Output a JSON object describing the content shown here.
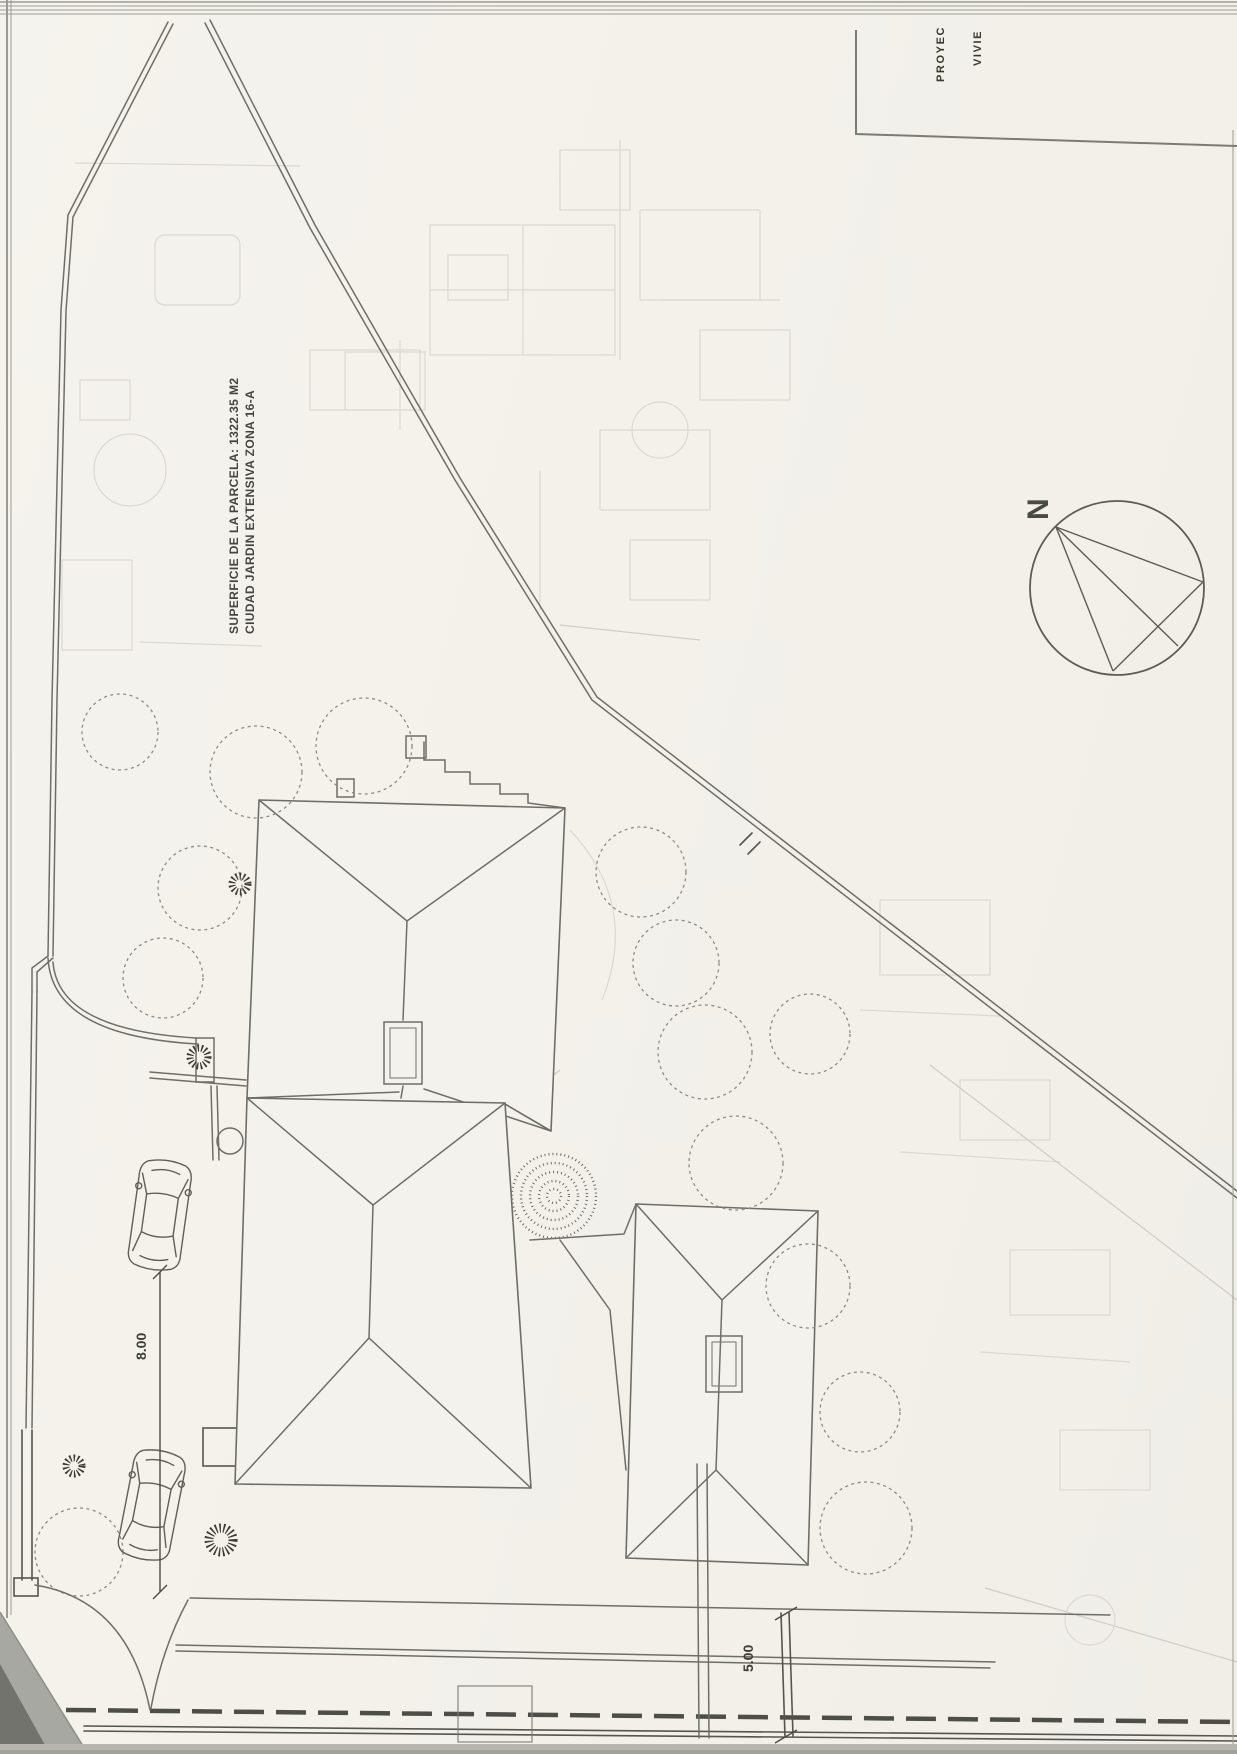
{
  "document": {
    "kind": "scanned architectural site plan (rotated landscape drawing)",
    "title_block": {
      "line1": "PROYEC",
      "line2": "VIVIE"
    },
    "annotations": {
      "parcel": {
        "line1": "SUPERFICIE DE LA PARCELA: 1322.35 M2",
        "line2": "CIUDAD JARDIN EXTENSIVA ZONA 16-A"
      },
      "north_label": "N",
      "dimension_8": "8.00",
      "dimension_5": "5.00"
    },
    "colors": {
      "paper": "#f3f1eb",
      "ink": "#6e6e68",
      "ink_dark": "#55554f",
      "bleed_through": "#d9d7d0",
      "scan_edge": "#9b9b95",
      "scan_corner_dark": "#73736e"
    }
  }
}
